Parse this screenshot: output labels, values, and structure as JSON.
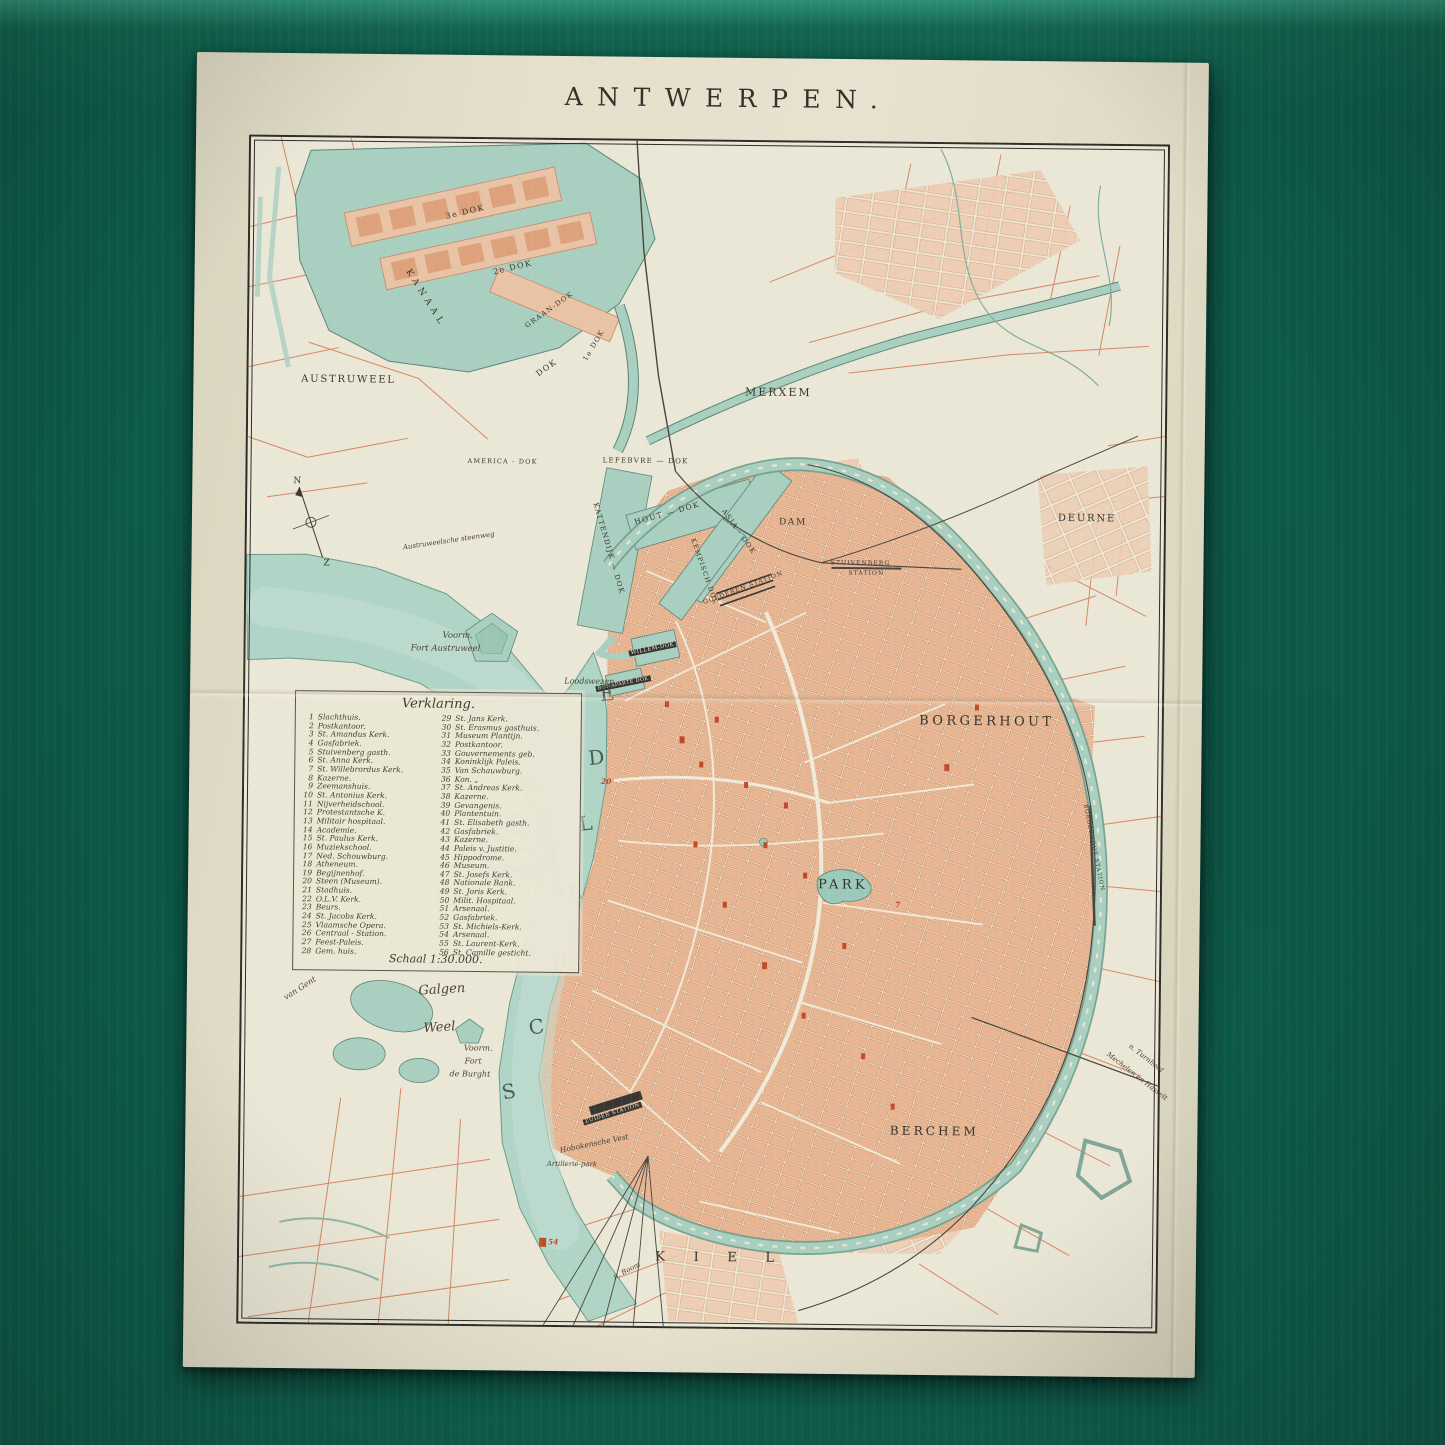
{
  "palette": {
    "background_green": "#0d5a49",
    "paper": "#e5e0cc",
    "map_base": "#ebe7d6",
    "water": "#a9cfc1",
    "river": "#b0d4c6",
    "city_blocks": "#e7b592",
    "landmark_red": "#c0472a",
    "line_ink": "#2f2d27",
    "road_red": "#d4815f"
  },
  "map": {
    "title": "ANTWERPEN.",
    "legend": {
      "heading": "Verklaring.",
      "scale_label": "Schaal 1:30.000.",
      "col1": [
        {
          "n": "1",
          "label": "Slachthuis."
        },
        {
          "n": "2",
          "label": "Postkantoor."
        },
        {
          "n": "3",
          "label": "St. Amandus Kerk."
        },
        {
          "n": "4",
          "label": "Gasfabriek."
        },
        {
          "n": "5",
          "label": "Stuivenberg gasth."
        },
        {
          "n": "6",
          "label": "St. Anna Kerk."
        },
        {
          "n": "7",
          "label": "St. Willebrordus Kerk."
        },
        {
          "n": "8",
          "label": "Kazerne."
        },
        {
          "n": "9",
          "label": "Zeemanshuis."
        },
        {
          "n": "10",
          "label": "St. Antonius Kerk."
        },
        {
          "n": "11",
          "label": "Nijverheidschool."
        },
        {
          "n": "12",
          "label": "Protestantsche K."
        },
        {
          "n": "13",
          "label": "Militair hospitaal."
        },
        {
          "n": "14",
          "label": "Academie."
        },
        {
          "n": "15",
          "label": "St. Paulus Kerk."
        },
        {
          "n": "16",
          "label": "Muziekschool."
        },
        {
          "n": "17",
          "label": "Ned. Schouwburg."
        },
        {
          "n": "18",
          "label": "Atheneum."
        },
        {
          "n": "19",
          "label": "Begijnenhof."
        },
        {
          "n": "20",
          "label": "Steen (Museum)."
        },
        {
          "n": "21",
          "label": "Stadhuis."
        },
        {
          "n": "22",
          "label": "O.L.V. Kerk."
        },
        {
          "n": "23",
          "label": "Beurs."
        },
        {
          "n": "24",
          "label": "St. Jacobs Kerk."
        },
        {
          "n": "25",
          "label": "Vlaamsche Opera."
        },
        {
          "n": "26",
          "label": "Centraal - Station."
        },
        {
          "n": "27",
          "label": "Feest-Paleis."
        },
        {
          "n": "28",
          "label": "Gem. huis."
        }
      ],
      "col2": [
        {
          "n": "29",
          "label": "St. Jans Kerk."
        },
        {
          "n": "30",
          "label": "St. Erasmus gasthuis."
        },
        {
          "n": "31",
          "label": "Museum Plantijn."
        },
        {
          "n": "32",
          "label": "Postkantoor."
        },
        {
          "n": "33",
          "label": "Gouvernements geb."
        },
        {
          "n": "34",
          "label": "Koninklijk Paleis."
        },
        {
          "n": "35",
          "label": "Van Schauwburg."
        },
        {
          "n": "36",
          "label": "Kon.  „"
        },
        {
          "n": "37",
          "label": "St. Andreas Kerk."
        },
        {
          "n": "38",
          "label": "Kazerne."
        },
        {
          "n": "39",
          "label": "Gevangenis."
        },
        {
          "n": "40",
          "label": "Plantentuin."
        },
        {
          "n": "41",
          "label": "St. Elisabeth gasth."
        },
        {
          "n": "42",
          "label": "Gasfabriek."
        },
        {
          "n": "43",
          "label": "Kazerne."
        },
        {
          "n": "44",
          "label": "Paleis v. Justitie."
        },
        {
          "n": "45",
          "label": "Hippodrome."
        },
        {
          "n": "46",
          "label": "Museum."
        },
        {
          "n": "47",
          "label": "St. Josefs Kerk."
        },
        {
          "n": "48",
          "label": "Nationale Bank."
        },
        {
          "n": "49",
          "label": "St. Joris Kerk."
        },
        {
          "n": "50",
          "label": "Milit. Hospitaal."
        },
        {
          "n": "51",
          "label": "Arsenaal."
        },
        {
          "n": "52",
          "label": "Gasfabriek."
        },
        {
          "n": "53",
          "label": "St. Michiels-Kerk."
        },
        {
          "n": "54",
          "label": "Arsenaal."
        },
        {
          "n": "55",
          "label": "St. Laurent-Kerk."
        },
        {
          "n": "56",
          "label": "St. Camille gesticht."
        }
      ]
    },
    "labels": {
      "dok3": "3e DOK",
      "dok2": "2e DOK",
      "graandok": "GRAAN-DOK",
      "kanaal": "KANAAL",
      "dokmid": "DOK",
      "dok1": "1e DOK",
      "austruweel": "AUSTRUWEEL",
      "merxem": "MERXEM",
      "deurne": "DEURNE",
      "america": "AMERICA - DOK",
      "lefebvre": "LEFEBVRE — DOK",
      "kattendijk": "KATTENDIJK — DOK",
      "houtdok": "HOUT — DOK",
      "asiadok": "ASIA - DOK",
      "kempisch": "KEMPISCH DOK",
      "dam": "DAM",
      "stuiv1": "STUIVENBERG",
      "stuiv2": "STATION",
      "goederen": "GOEDEREN STATION",
      "willemdok": "WILLEM-DOK",
      "bonaparte": "BONAPARTE DOK",
      "borgerhout": "BORGERHOUT",
      "park": "PARK",
      "berchem": "BERCHEM",
      "kiel": "KIEL",
      "sch1": "S",
      "sch2": "C",
      "sch3": "H",
      "sch4": "E",
      "sch5": "L",
      "sch6": "D",
      "sch7": "E",
      "vlhoofd": "Vlaamsche Hoofd",
      "fvh1": "Fort",
      "fvh2": "Vlaamsche",
      "fvh3": "Hoofd",
      "badinricht": "Badinricht.",
      "vfa1": "Voorm.",
      "vfa2": "Fort Austruweel",
      "scheepswerf": "Scheepswerf",
      "loodswezen": "Loodswezen",
      "galgen": "Galgen",
      "weel": "Weel",
      "vfb1": "Voorm.",
      "vfb2": "Fort",
      "vfb3": "de Burght",
      "vangent": "van Gent",
      "zuider": "ZUIDER STATION",
      "hoboken": "Hobokensche Vest",
      "artillerie": "Artillerie-park",
      "turnhout": "n. Turnhout",
      "mechelen": "Mechelen en Hasselt",
      "nboom": "n. Boom",
      "austrsw": "Austruweelsche steenweg",
      "borgstation": "BORGERHOUT STATION",
      "compass_n": "N",
      "compass_z": "Z",
      "m20": "20",
      "m7": "7",
      "m54": "54"
    }
  }
}
